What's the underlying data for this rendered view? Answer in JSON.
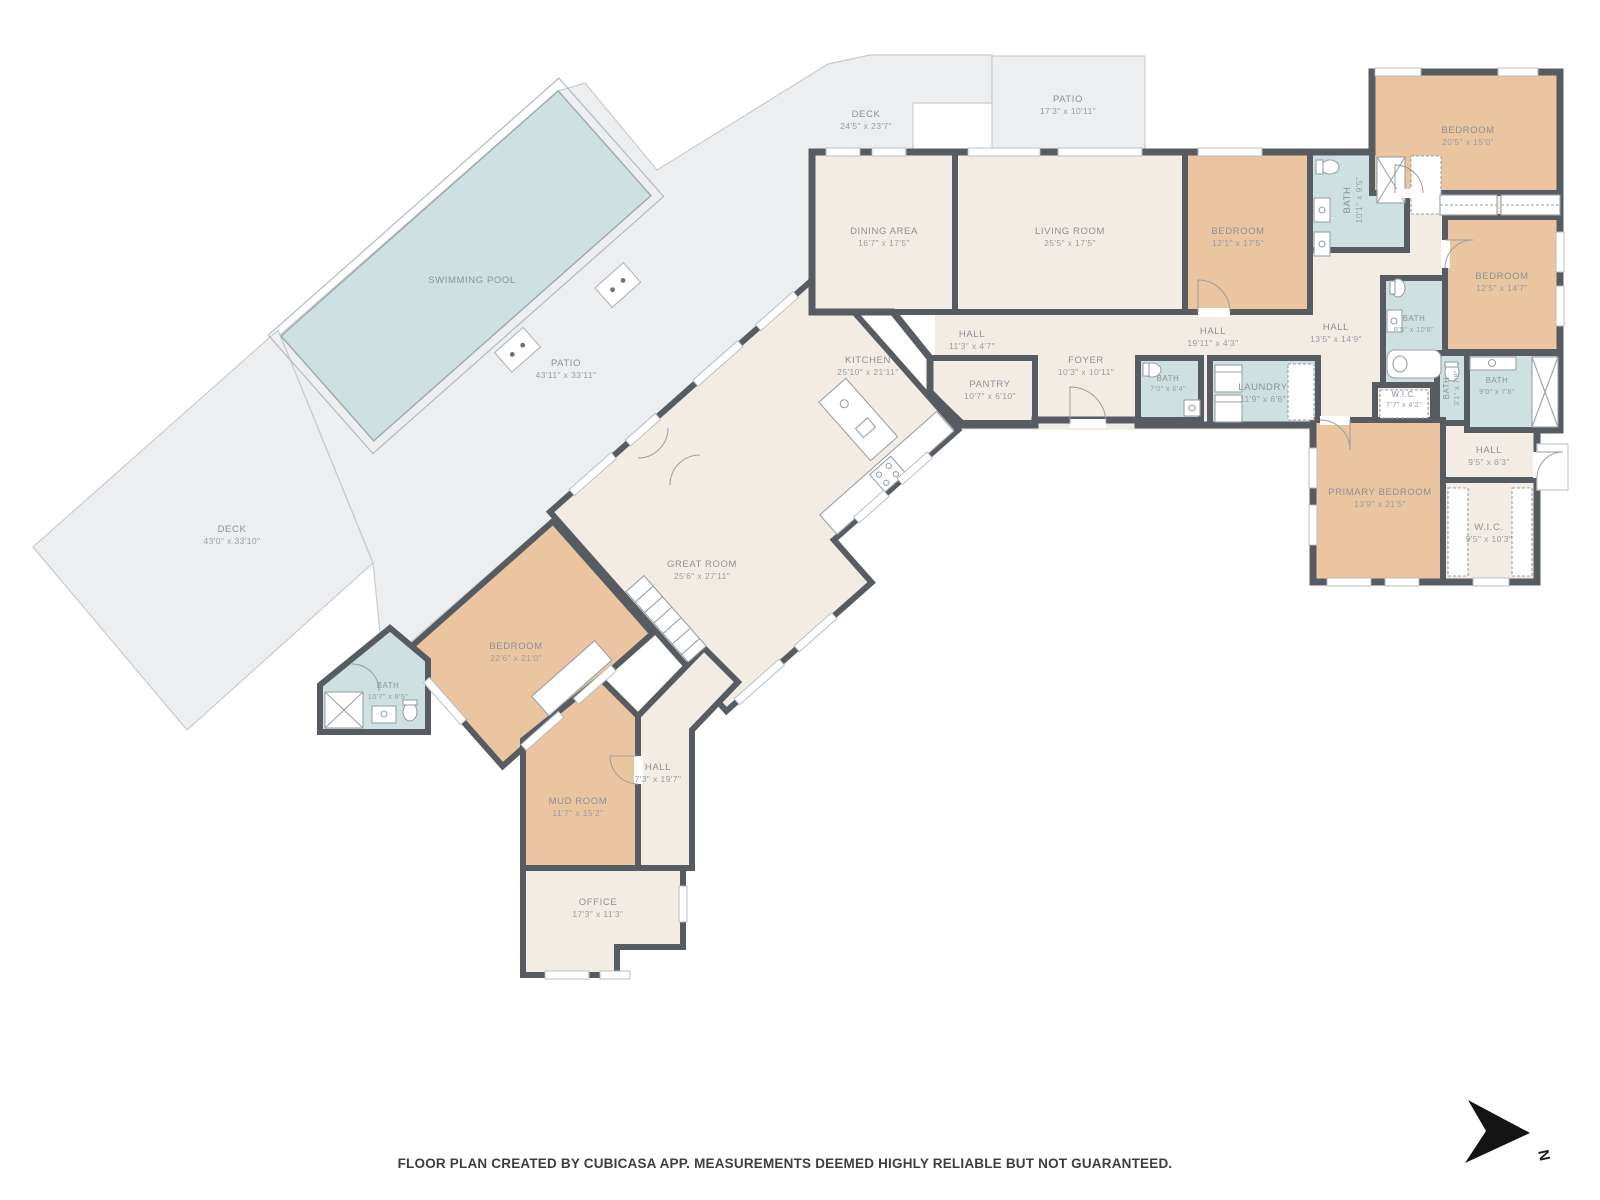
{
  "meta": {
    "footer": "FLOOR PLAN CREATED BY CUBICASA APP. MEASUREMENTS DEEMED HIGHLY RELIABLE BUT NOT GUARANTEED.",
    "north_label": "N"
  },
  "palette": {
    "wall": "#575c63",
    "common_room": "#f3ece4",
    "bedroom": "#ebc5a0",
    "bath": "#cfe0e0",
    "outdoor": "#eceeef",
    "pool": "#cde0e2",
    "fixture_line": "#9aa1a7",
    "label_text": "#8b9197"
  },
  "rooms": [
    {
      "name": "SWIMMING POOL",
      "dims": ""
    },
    {
      "name": "PATIO",
      "dims": "43'11\" x 33'11\""
    },
    {
      "name": "DECK",
      "dims": "43'0\" x 33'10\""
    },
    {
      "name": "DECK",
      "dims": "24'5\" x 23'7\""
    },
    {
      "name": "PATIO",
      "dims": "17'3\" x 10'11\""
    },
    {
      "name": "DINING AREA",
      "dims": "16'7\" x 17'5\""
    },
    {
      "name": "LIVING ROOM",
      "dims": "25'5\" x 17'5\""
    },
    {
      "name": "BEDROOM",
      "dims": "12'1\" x 17'5\""
    },
    {
      "name": "BATH",
      "dims": "10'1\" x 9'5\""
    },
    {
      "name": "BEDROOM",
      "dims": "20'5\" x 15'0\""
    },
    {
      "name": "BEDROOM",
      "dims": "12'5\" x 14'7\""
    },
    {
      "name": "HALL",
      "dims": "11'3\" x 4'7\""
    },
    {
      "name": "HALL",
      "dims": "19'11\" x 4'3\""
    },
    {
      "name": "HALL",
      "dims": "13'5\" x 14'9\""
    },
    {
      "name": "BATH",
      "dims": "8'5\" x 10'6\""
    },
    {
      "name": "KITCHEN",
      "dims": "25'10\" x 21'11\""
    },
    {
      "name": "PANTRY",
      "dims": "10'7\" x 6'10\""
    },
    {
      "name": "FOYER",
      "dims": "10'3\" x 10'11\""
    },
    {
      "name": "BATH",
      "dims": "7'0\" x 6'4\""
    },
    {
      "name": "LAUNDRY",
      "dims": "11'9\" x 6'6\""
    },
    {
      "name": "W.I.C.",
      "dims": "7'7\" x 4'2\""
    },
    {
      "name": "BATH",
      "dims": "3'1\" x 7'8\""
    },
    {
      "name": "BATH",
      "dims": "9'0\" x 7'8\""
    },
    {
      "name": "HALL",
      "dims": "9'5\" x 6'3\""
    },
    {
      "name": "PRIMARY BEDROOM",
      "dims": "13'9\" x 21'5\""
    },
    {
      "name": "W.I.C.",
      "dims": "9'5\" x 10'3\""
    },
    {
      "name": "GREAT ROOM",
      "dims": "25'6\" x 27'11\""
    },
    {
      "name": "BEDROOM",
      "dims": "22'6\" x 21'0\""
    },
    {
      "name": "BATH",
      "dims": "10'7\" x 8'5\""
    },
    {
      "name": "MUD ROOM",
      "dims": "11'7\" x 15'2\""
    },
    {
      "name": "HALL",
      "dims": "7'3\" x 19'7\""
    },
    {
      "name": "OFFICE",
      "dims": "17'3\" x 11'3\""
    }
  ]
}
